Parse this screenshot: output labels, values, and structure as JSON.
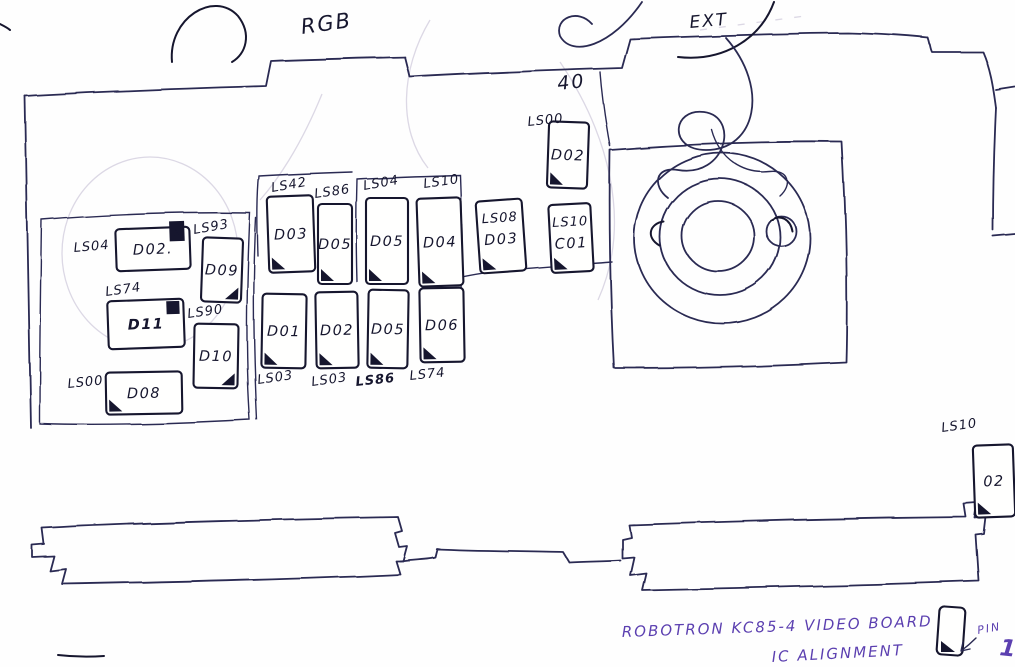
{
  "title": {
    "line1": "ROBOTRON  KC85-4  VIDEO BOARD",
    "line2": "IC ALIGNMENT"
  },
  "annotations": {
    "rgb": "RGB",
    "ext": "EXT",
    "dip40": "40",
    "pin_label": "PIN",
    "pin_number": "1"
  },
  "colors": {
    "ink": "#2a2a52",
    "ink_dark": "#16162e",
    "pencil": "#b9b2cc",
    "purple": "#5b3fb0",
    "paper": "#fefefe"
  },
  "chips": [
    {
      "group": "left-block",
      "type": "LS04",
      "designator": "D02.",
      "x": 116,
      "y": 228,
      "w": 74,
      "h": 42,
      "rot": -2,
      "lx": 74,
      "ly": 252,
      "lrot": -5,
      "marker": "notch-n",
      "marker_label": "N"
    },
    {
      "group": "left-block",
      "type": "LS93",
      "designator": "D09",
      "x": 202,
      "y": 238,
      "w": 40,
      "h": 64,
      "rot": 2,
      "lx": 194,
      "ly": 234,
      "lrot": -10,
      "marker": "br"
    },
    {
      "group": "left-block",
      "type": "LS74",
      "designator": "D11",
      "x": 108,
      "y": 300,
      "w": 76,
      "h": 48,
      "rot": -2,
      "lx": 106,
      "ly": 296,
      "lrot": -8,
      "marker": "box-tr",
      "bold": true,
      "desSize": 21
    },
    {
      "group": "left-block",
      "type": "LS90",
      "designator": "D10",
      "x": 194,
      "y": 324,
      "w": 44,
      "h": 64,
      "rot": 1,
      "lx": 188,
      "ly": 318,
      "lrot": -8,
      "marker": "br"
    },
    {
      "group": "left-block",
      "type": "LS00",
      "designator": "D08",
      "x": 106,
      "y": 372,
      "w": 76,
      "h": 42,
      "rot": -1,
      "lx": 68,
      "ly": 388,
      "lrot": -6,
      "marker": "bl",
      "desSize": 17
    },
    {
      "group": "middle-top-row",
      "type": "LS42",
      "designator": "D03",
      "x": 268,
      "y": 196,
      "w": 46,
      "h": 76,
      "rot": -2,
      "lx": 272,
      "ly": 192,
      "lrot": -10,
      "marker": "bl"
    },
    {
      "group": "middle-top-row",
      "type": "LS86",
      "designator": "D05",
      "x": 318,
      "y": 204,
      "w": 34,
      "h": 80,
      "rot": 0,
      "lx": 315,
      "ly": 198,
      "lrot": -8,
      "marker": "bl"
    },
    {
      "group": "middle-top-row",
      "type": "LS04",
      "designator": "D05",
      "x": 366,
      "y": 198,
      "w": 42,
      "h": 86,
      "rot": 0,
      "lx": 364,
      "ly": 190,
      "lrot": -10,
      "marker": "bl"
    },
    {
      "group": "middle-top-row",
      "type": "LS10",
      "designator": "D04",
      "x": 418,
      "y": 198,
      "w": 44,
      "h": 88,
      "rot": -2,
      "lx": 424,
      "ly": 188,
      "lrot": -8,
      "marker": "bl"
    },
    {
      "group": "middle-bottom-row",
      "type": "LS03",
      "designator": "D01",
      "x": 262,
      "y": 294,
      "w": 44,
      "h": 74,
      "rot": 1,
      "lx": 258,
      "ly": 384,
      "lrot": -8,
      "marker": "bl"
    },
    {
      "group": "middle-bottom-row",
      "type": "LS03",
      "designator": "D02",
      "x": 316,
      "y": 292,
      "w": 42,
      "h": 76,
      "rot": -1,
      "lx": 312,
      "ly": 386,
      "lrot": -8,
      "marker": "bl"
    },
    {
      "group": "middle-bottom-row",
      "type": "LS86",
      "designator": "D05",
      "x": 368,
      "y": 290,
      "w": 40,
      "h": 78,
      "rot": 1,
      "lx": 356,
      "ly": 386,
      "lrot": -6,
      "marker": "bl",
      "boldType": true
    },
    {
      "group": "middle-bottom-row",
      "type": "LS74",
      "designator": "D06",
      "x": 420,
      "y": 288,
      "w": 44,
      "h": 74,
      "rot": -1,
      "lx": 410,
      "ly": 380,
      "lrot": -6,
      "marker": "bl"
    },
    {
      "group": "right-pair",
      "type": "LS08",
      "designator": "D03",
      "x": 478,
      "y": 200,
      "w": 46,
      "h": 72,
      "rot": -4,
      "inside": true,
      "marker": "bl"
    },
    {
      "group": "right-pair",
      "type": "LS10",
      "designator": "C01",
      "x": 550,
      "y": 204,
      "w": 42,
      "h": 68,
      "rot": -3,
      "inside": true,
      "marker": "bl"
    },
    {
      "group": "top",
      "type": "LS00",
      "designator": "D02",
      "x": 548,
      "y": 122,
      "w": 40,
      "h": 66,
      "rot": 2,
      "lx": 528,
      "ly": 126,
      "lrot": -6,
      "marker": "bl"
    },
    {
      "group": "board-right-edge",
      "type": "LS10",
      "designator": "02",
      "x": 974,
      "y": 445,
      "w": 40,
      "h": 72,
      "rot": -2,
      "lx": 942,
      "ly": 432,
      "lrot": -8,
      "marker": "bl"
    }
  ]
}
